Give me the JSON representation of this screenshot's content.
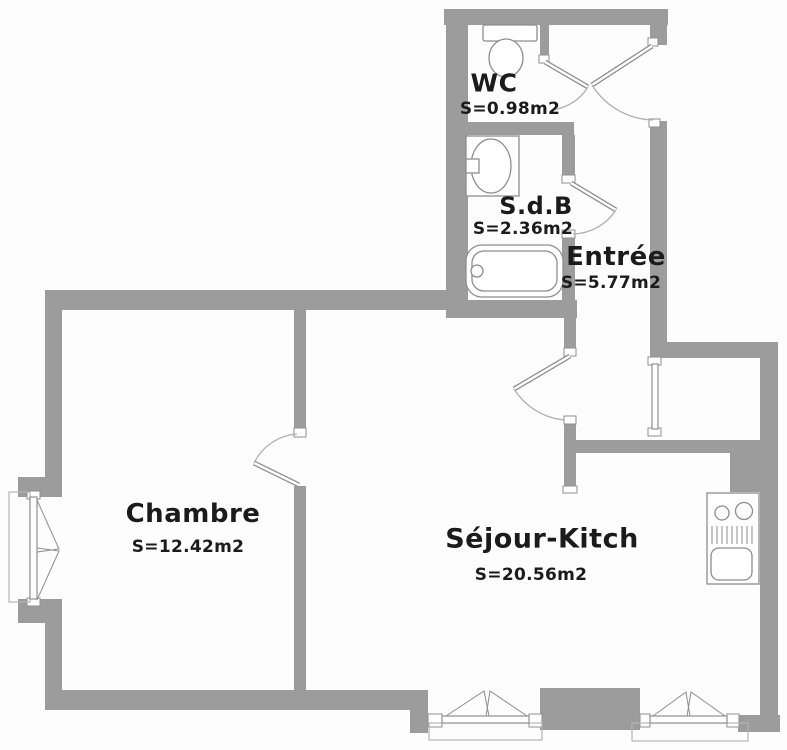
{
  "colors": {
    "wall": "#9c9c9c",
    "line": "#8f8f8f",
    "fixture": "#8d8d8d",
    "text": "#1b1b1b",
    "background": "#fdfdfd"
  },
  "rooms": [
    {
      "id": "wc",
      "name": "WC",
      "area": "S=0.98m2"
    },
    {
      "id": "sdb",
      "name": "S.d.B",
      "area": "S=2.36m2"
    },
    {
      "id": "entree",
      "name": "Entrée",
      "area": "S=5.77m2"
    },
    {
      "id": "chambre",
      "name": "Chambre",
      "area": "S=12.42m2"
    },
    {
      "id": "sejour",
      "name": "Séjour-Kitch",
      "area": "S=20.56m2"
    }
  ]
}
